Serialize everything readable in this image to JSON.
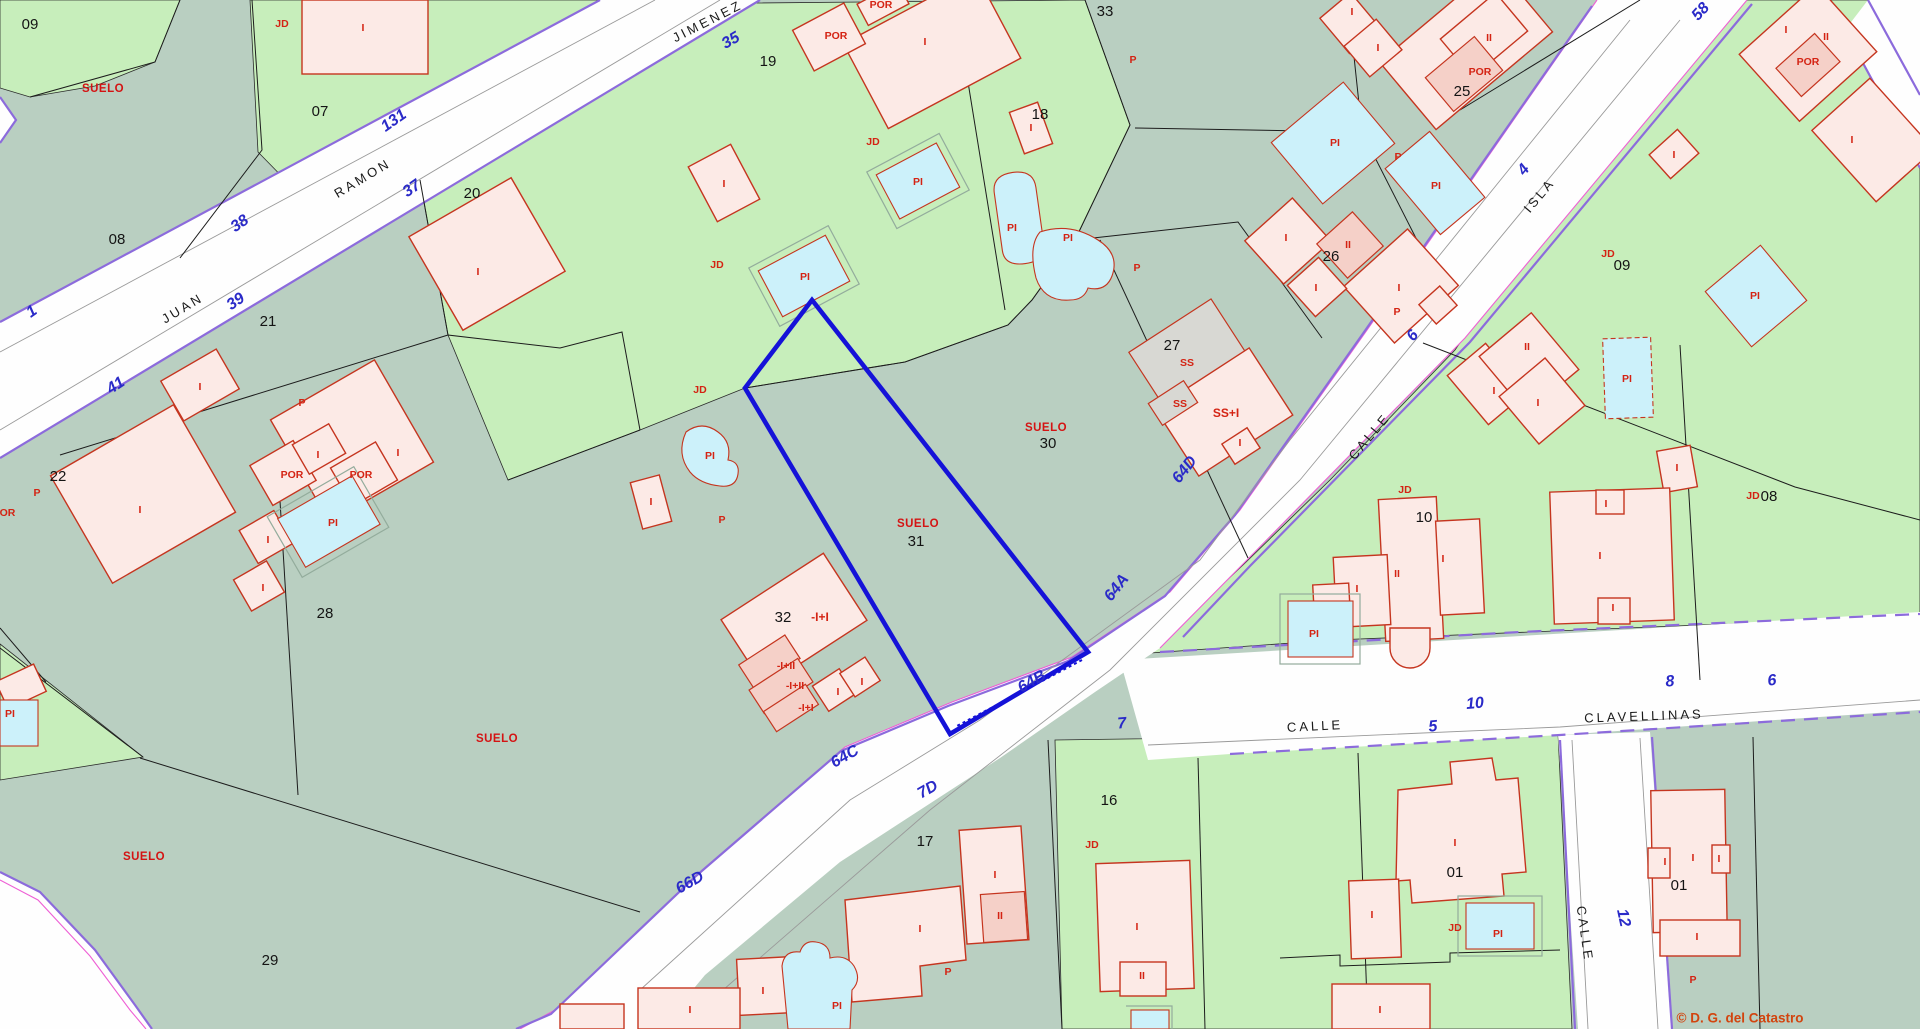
{
  "map": {
    "type": "cadastral-parcel-map",
    "watermark": "© D. G. del Catastro",
    "selected_parcel": "31",
    "colors": {
      "gray": "#b9cfc1",
      "green": "#c7eebb",
      "road": "#fefefe",
      "purple": "#8c6bdc",
      "magenta": "#ee5fd5",
      "blue": "#2a2ac8",
      "red": "#d42313",
      "bld": "#fceae6",
      "bld2": "#f5d0c8",
      "bldgray": "#d8d8d3",
      "bstroke": "#c5351f",
      "pool": "#ccf1fa",
      "sel": "#1512d8",
      "wm": "#d2440e"
    },
    "streets": [
      "JUAN RAMON JIMENEZ",
      "CALLE ISLA",
      "CALLE CLAVELLINAS",
      "CALLE"
    ],
    "labels": [
      {
        "t": "JUAN",
        "x": 183,
        "y": 309,
        "r": -31,
        "c": "street"
      },
      {
        "t": "RAMON",
        "x": 363,
        "y": 179,
        "r": -31,
        "c": "street"
      },
      {
        "t": "JIMENEZ",
        "x": 708,
        "y": 22,
        "r": -27,
        "c": "street"
      },
      {
        "t": "CALLE",
        "x": 1370,
        "y": 437,
        "r": -50,
        "c": "street"
      },
      {
        "t": "ISLA",
        "x": 1540,
        "y": 196,
        "r": -50,
        "c": "street"
      },
      {
        "t": "CALLE",
        "x": 1315,
        "y": 727,
        "r": -3,
        "c": "street"
      },
      {
        "t": "CLAVELLINAS",
        "x": 1644,
        "y": 717,
        "r": -2,
        "c": "street"
      },
      {
        "t": "CALLE",
        "x": 1584,
        "y": 934,
        "r": 82,
        "c": "street"
      },
      {
        "t": "1",
        "x": 32,
        "y": 312,
        "r": -35,
        "c": "bnum"
      },
      {
        "t": "41",
        "x": 116,
        "y": 386,
        "r": -33,
        "c": "bnum"
      },
      {
        "t": "39",
        "x": 236,
        "y": 302,
        "r": -35,
        "c": "bnum"
      },
      {
        "t": "38",
        "x": 240,
        "y": 224,
        "r": -35,
        "c": "bnum"
      },
      {
        "t": "37",
        "x": 412,
        "y": 189,
        "r": -35,
        "c": "bnum"
      },
      {
        "t": "131",
        "x": 394,
        "y": 121,
        "r": -35,
        "c": "bnum"
      },
      {
        "t": "35",
        "x": 731,
        "y": 41,
        "r": -30,
        "c": "bnum"
      },
      {
        "t": "58",
        "x": 1701,
        "y": 12,
        "r": -48,
        "c": "bnum"
      },
      {
        "t": "4",
        "x": 1524,
        "y": 170,
        "r": -50,
        "c": "bnum"
      },
      {
        "t": "6",
        "x": 1413,
        "y": 336,
        "r": -50,
        "c": "bnum"
      },
      {
        "t": "64D",
        "x": 1185,
        "y": 470,
        "r": -52,
        "c": "bnum"
      },
      {
        "t": "64A",
        "x": 1117,
        "y": 588,
        "r": -52,
        "c": "bnum"
      },
      {
        "t": "64B",
        "x": 1032,
        "y": 682,
        "r": -30,
        "c": "bnum"
      },
      {
        "t": "64C",
        "x": 845,
        "y": 757,
        "r": -30,
        "c": "bnum"
      },
      {
        "t": "7D",
        "x": 928,
        "y": 790,
        "r": -30,
        "c": "bnum"
      },
      {
        "t": "66D",
        "x": 690,
        "y": 883,
        "r": -30,
        "c": "bnum"
      },
      {
        "t": "7",
        "x": 1122,
        "y": 724,
        "r": -5,
        "c": "bnum"
      },
      {
        "t": "5",
        "x": 1433,
        "y": 727,
        "r": -5,
        "c": "bnum"
      },
      {
        "t": "10",
        "x": 1475,
        "y": 704,
        "r": -5,
        "c": "bnum"
      },
      {
        "t": "8",
        "x": 1670,
        "y": 682,
        "r": -5,
        "c": "bnum"
      },
      {
        "t": "6",
        "x": 1772,
        "y": 681,
        "r": -5,
        "c": "bnum"
      },
      {
        "t": "12",
        "x": 1623,
        "y": 918,
        "r": 78,
        "c": "bnum"
      },
      {
        "t": "09",
        "x": 30,
        "y": 25,
        "r": 0,
        "c": "pnum"
      },
      {
        "t": "08",
        "x": 117,
        "y": 240,
        "r": 0,
        "c": "pnum"
      },
      {
        "t": "07",
        "x": 320,
        "y": 112,
        "r": 0,
        "c": "pnum"
      },
      {
        "t": "20",
        "x": 472,
        "y": 194,
        "r": 0,
        "c": "pnum"
      },
      {
        "t": "21",
        "x": 268,
        "y": 322,
        "r": 0,
        "c": "pnum"
      },
      {
        "t": "22",
        "x": 58,
        "y": 477,
        "r": 0,
        "c": "pnum"
      },
      {
        "t": "28",
        "x": 325,
        "y": 614,
        "r": 0,
        "c": "pnum"
      },
      {
        "t": "29",
        "x": 270,
        "y": 961,
        "r": 0,
        "c": "pnum"
      },
      {
        "t": "19",
        "x": 768,
        "y": 62,
        "r": 0,
        "c": "pnum"
      },
      {
        "t": "18",
        "x": 1040,
        "y": 115,
        "r": 0,
        "c": "pnum"
      },
      {
        "t": "33",
        "x": 1105,
        "y": 12,
        "r": 0,
        "c": "pnum"
      },
      {
        "t": "25",
        "x": 1462,
        "y": 92,
        "r": 0,
        "c": "pnum"
      },
      {
        "t": "26",
        "x": 1331,
        "y": 257,
        "r": 0,
        "c": "pnum"
      },
      {
        "t": "27",
        "x": 1172,
        "y": 346,
        "r": 0,
        "c": "pnum"
      },
      {
        "t": "30",
        "x": 1048,
        "y": 444,
        "r": 0,
        "c": "pnum"
      },
      {
        "t": "31",
        "x": 916,
        "y": 542,
        "r": 0,
        "c": "pnum"
      },
      {
        "t": "32",
        "x": 783,
        "y": 618,
        "r": 0,
        "c": "pnum"
      },
      {
        "t": "17",
        "x": 925,
        "y": 842,
        "r": 0,
        "c": "pnum"
      },
      {
        "t": "16",
        "x": 1109,
        "y": 801,
        "r": 0,
        "c": "pnum"
      },
      {
        "t": "10",
        "x": 1424,
        "y": 518,
        "r": 0,
        "c": "pnum"
      },
      {
        "t": "09",
        "x": 1622,
        "y": 266,
        "r": 0,
        "c": "pnum"
      },
      {
        "t": "08",
        "x": 1769,
        "y": 497,
        "r": 0,
        "c": "pnum"
      },
      {
        "t": "01",
        "x": 1455,
        "y": 873,
        "r": 0,
        "c": "pnum"
      },
      {
        "t": "01",
        "x": 1679,
        "y": 886,
        "r": 0,
        "c": "pnum"
      },
      {
        "t": "SUELO",
        "x": 103,
        "y": 89,
        "r": 0,
        "c": "suelo"
      },
      {
        "t": "SUELO",
        "x": 1046,
        "y": 428,
        "r": 0,
        "c": "suelo"
      },
      {
        "t": "SUELO",
        "x": 918,
        "y": 524,
        "r": 0,
        "c": "suelo"
      },
      {
        "t": "SUELO",
        "x": 497,
        "y": 739,
        "r": 0,
        "c": "suelo"
      },
      {
        "t": "SUELO",
        "x": 144,
        "y": 857,
        "r": 0,
        "c": "suelo"
      },
      {
        "t": "-I+I",
        "x": 820,
        "y": 618,
        "r": 0,
        "c": "redm"
      },
      {
        "t": "-I+II",
        "x": 786,
        "y": 666,
        "r": 0,
        "c": "red"
      },
      {
        "t": "-I+II",
        "x": 795,
        "y": 686,
        "r": 0,
        "c": "red"
      },
      {
        "t": "-I+I",
        "x": 806,
        "y": 708,
        "r": 0,
        "c": "red"
      },
      {
        "t": "SS",
        "x": 1187,
        "y": 363,
        "r": 0,
        "c": "red"
      },
      {
        "t": "SS",
        "x": 1180,
        "y": 404,
        "r": 0,
        "c": "red"
      },
      {
        "t": "SS+I",
        "x": 1226,
        "y": 414,
        "r": 0,
        "c": "redm"
      },
      {
        "t": "JD",
        "x": 282,
        "y": 24,
        "r": 0,
        "c": "red"
      },
      {
        "t": "JD",
        "x": 873,
        "y": 142,
        "r": 0,
        "c": "red"
      },
      {
        "t": "JD",
        "x": 717,
        "y": 265,
        "r": 0,
        "c": "red"
      },
      {
        "t": "JD",
        "x": 700,
        "y": 390,
        "r": 0,
        "c": "red"
      },
      {
        "t": "JD",
        "x": 1608,
        "y": 254,
        "r": 0,
        "c": "red"
      },
      {
        "t": "JD",
        "x": 1405,
        "y": 490,
        "r": 0,
        "c": "red"
      },
      {
        "t": "JD",
        "x": 1753,
        "y": 496,
        "r": 0,
        "c": "red"
      },
      {
        "t": "JD",
        "x": 1092,
        "y": 845,
        "r": 0,
        "c": "red"
      },
      {
        "t": "JD",
        "x": 1455,
        "y": 928,
        "r": 0,
        "c": "red"
      },
      {
        "t": "P",
        "x": 1133,
        "y": 60,
        "r": 0,
        "c": "red"
      },
      {
        "t": "P",
        "x": 1398,
        "y": 157,
        "r": 0,
        "c": "red"
      },
      {
        "t": "P",
        "x": 302,
        "y": 403,
        "r": 0,
        "c": "red"
      },
      {
        "t": "P",
        "x": 37,
        "y": 493,
        "r": 0,
        "c": "red"
      },
      {
        "t": "P",
        "x": 722,
        "y": 520,
        "r": 0,
        "c": "red"
      },
      {
        "t": "P",
        "x": 1137,
        "y": 268,
        "r": 0,
        "c": "red"
      },
      {
        "t": "P",
        "x": 1397,
        "y": 312,
        "r": 0,
        "c": "red"
      },
      {
        "t": "P",
        "x": 948,
        "y": 972,
        "r": 0,
        "c": "red"
      },
      {
        "t": "P",
        "x": 1693,
        "y": 980,
        "r": 0,
        "c": "red"
      },
      {
        "t": "POR",
        "x": 836,
        "y": 36,
        "r": 0,
        "c": "red"
      },
      {
        "t": "POR",
        "x": 881,
        "y": 5,
        "r": 0,
        "c": "red"
      },
      {
        "t": "POR",
        "x": 1480,
        "y": 72,
        "r": 0,
        "c": "red"
      },
      {
        "t": "POR",
        "x": 1808,
        "y": 62,
        "r": 0,
        "c": "red"
      },
      {
        "t": "POR",
        "x": 292,
        "y": 475,
        "r": 0,
        "c": "red"
      },
      {
        "t": "POR",
        "x": 361,
        "y": 475,
        "r": 0,
        "c": "red"
      },
      {
        "t": "POR",
        "x": 4,
        "y": 513,
        "r": 0,
        "c": "red"
      },
      {
        "t": "PI",
        "x": 918,
        "y": 182,
        "r": 0,
        "c": "red"
      },
      {
        "t": "PI",
        "x": 805,
        "y": 277,
        "r": 0,
        "c": "red"
      },
      {
        "t": "PI",
        "x": 1012,
        "y": 228,
        "r": 0,
        "c": "red"
      },
      {
        "t": "PI",
        "x": 1068,
        "y": 238,
        "r": 0,
        "c": "red"
      },
      {
        "t": "PI",
        "x": 1335,
        "y": 143,
        "r": 0,
        "c": "red"
      },
      {
        "t": "PI",
        "x": 1436,
        "y": 186,
        "r": 0,
        "c": "red"
      },
      {
        "t": "PI",
        "x": 1755,
        "y": 296,
        "r": 0,
        "c": "red"
      },
      {
        "t": "PI",
        "x": 1627,
        "y": 379,
        "r": 0,
        "c": "red"
      },
      {
        "t": "PI",
        "x": 1314,
        "y": 634,
        "r": 0,
        "c": "red"
      },
      {
        "t": "PI",
        "x": 710,
        "y": 456,
        "r": 0,
        "c": "red"
      },
      {
        "t": "PI",
        "x": 333,
        "y": 523,
        "r": 0,
        "c": "red"
      },
      {
        "t": "PI",
        "x": 1498,
        "y": 934,
        "r": 0,
        "c": "red"
      },
      {
        "t": "PI",
        "x": 837,
        "y": 1006,
        "r": 0,
        "c": "red"
      },
      {
        "t": "PI",
        "x": 10,
        "y": 714,
        "r": 0,
        "c": "red"
      },
      {
        "t": "I",
        "x": 363,
        "y": 28,
        "r": 0,
        "c": "red"
      },
      {
        "t": "I",
        "x": 925,
        "y": 42,
        "r": 0,
        "c": "red"
      },
      {
        "t": "I",
        "x": 478,
        "y": 272,
        "r": 0,
        "c": "red"
      },
      {
        "t": "I",
        "x": 724,
        "y": 184,
        "r": 0,
        "c": "red"
      },
      {
        "t": "I",
        "x": 1031,
        "y": 128,
        "r": 0,
        "c": "red"
      },
      {
        "t": "I",
        "x": 200,
        "y": 387,
        "r": 0,
        "c": "red"
      },
      {
        "t": "I",
        "x": 398,
        "y": 453,
        "r": 0,
        "c": "red"
      },
      {
        "t": "I",
        "x": 318,
        "y": 455,
        "r": 0,
        "c": "red"
      },
      {
        "t": "I",
        "x": 268,
        "y": 540,
        "r": 0,
        "c": "red"
      },
      {
        "t": "I",
        "x": 263,
        "y": 588,
        "r": 0,
        "c": "red"
      },
      {
        "t": "I",
        "x": 140,
        "y": 510,
        "r": 0,
        "c": "red"
      },
      {
        "t": "I",
        "x": 651,
        "y": 502,
        "r": 0,
        "c": "red"
      },
      {
        "t": "I",
        "x": 838,
        "y": 692,
        "r": 0,
        "c": "red"
      },
      {
        "t": "I",
        "x": 862,
        "y": 682,
        "r": 0,
        "c": "red"
      },
      {
        "t": "I",
        "x": 1286,
        "y": 238,
        "r": 0,
        "c": "red"
      },
      {
        "t": "II",
        "x": 1348,
        "y": 245,
        "r": 0,
        "c": "red"
      },
      {
        "t": "I",
        "x": 1316,
        "y": 288,
        "r": 0,
        "c": "red"
      },
      {
        "t": "I",
        "x": 1399,
        "y": 288,
        "r": 0,
        "c": "red"
      },
      {
        "t": "I",
        "x": 1240,
        "y": 443,
        "r": 0,
        "c": "red"
      },
      {
        "t": "I",
        "x": 1352,
        "y": 12,
        "r": 0,
        "c": "red"
      },
      {
        "t": "I",
        "x": 1378,
        "y": 48,
        "r": 0,
        "c": "red"
      },
      {
        "t": "II",
        "x": 1489,
        "y": 38,
        "r": 0,
        "c": "red"
      },
      {
        "t": "I",
        "x": 1674,
        "y": 155,
        "r": 0,
        "c": "red"
      },
      {
        "t": "I",
        "x": 1786,
        "y": 30,
        "r": 0,
        "c": "red"
      },
      {
        "t": "II",
        "x": 1826,
        "y": 37,
        "r": 0,
        "c": "red"
      },
      {
        "t": "I",
        "x": 1852,
        "y": 140,
        "r": 0,
        "c": "red"
      },
      {
        "t": "II",
        "x": 1527,
        "y": 347,
        "r": 0,
        "c": "red"
      },
      {
        "t": "I",
        "x": 1494,
        "y": 391,
        "r": 0,
        "c": "red"
      },
      {
        "t": "I",
        "x": 1538,
        "y": 403,
        "r": 0,
        "c": "red"
      },
      {
        "t": "I",
        "x": 1677,
        "y": 468,
        "r": 0,
        "c": "red"
      },
      {
        "t": "I",
        "x": 1443,
        "y": 559,
        "r": 0,
        "c": "red"
      },
      {
        "t": "II",
        "x": 1397,
        "y": 574,
        "r": 0,
        "c": "red"
      },
      {
        "t": "I",
        "x": 1357,
        "y": 589,
        "r": 0,
        "c": "red"
      },
      {
        "t": "I",
        "x": 1600,
        "y": 556,
        "r": 0,
        "c": "red"
      },
      {
        "t": "I",
        "x": 1606,
        "y": 504,
        "r": 0,
        "c": "red"
      },
      {
        "t": "I",
        "x": 1613,
        "y": 608,
        "r": 0,
        "c": "red"
      },
      {
        "t": "I",
        "x": 1455,
        "y": 843,
        "r": 0,
        "c": "red"
      },
      {
        "t": "I",
        "x": 1372,
        "y": 915,
        "r": 0,
        "c": "red"
      },
      {
        "t": "I",
        "x": 1380,
        "y": 1010,
        "r": 0,
        "c": "red"
      },
      {
        "t": "I",
        "x": 1137,
        "y": 927,
        "r": 0,
        "c": "red"
      },
      {
        "t": "II",
        "x": 1142,
        "y": 976,
        "r": 0,
        "c": "red"
      },
      {
        "t": "I",
        "x": 995,
        "y": 875,
        "r": 0,
        "c": "red"
      },
      {
        "t": "II",
        "x": 1000,
        "y": 916,
        "r": 0,
        "c": "red"
      },
      {
        "t": "I",
        "x": 920,
        "y": 929,
        "r": 0,
        "c": "red"
      },
      {
        "t": "I",
        "x": 763,
        "y": 991,
        "r": 0,
        "c": "red"
      },
      {
        "t": "I",
        "x": 690,
        "y": 1010,
        "r": 0,
        "c": "red"
      },
      {
        "t": "I",
        "x": 1693,
        "y": 858,
        "r": 0,
        "c": "red"
      },
      {
        "t": "I",
        "x": 1665,
        "y": 862,
        "r": 0,
        "c": "red"
      },
      {
        "t": "I",
        "x": 1719,
        "y": 859,
        "r": 0,
        "c": "red"
      },
      {
        "t": "I",
        "x": 1697,
        "y": 937,
        "r": 0,
        "c": "red"
      },
      {
        "t": "© D. G. del Catastro",
        "x": 1740,
        "y": 1019,
        "r": 0,
        "c": "wm"
      }
    ]
  }
}
